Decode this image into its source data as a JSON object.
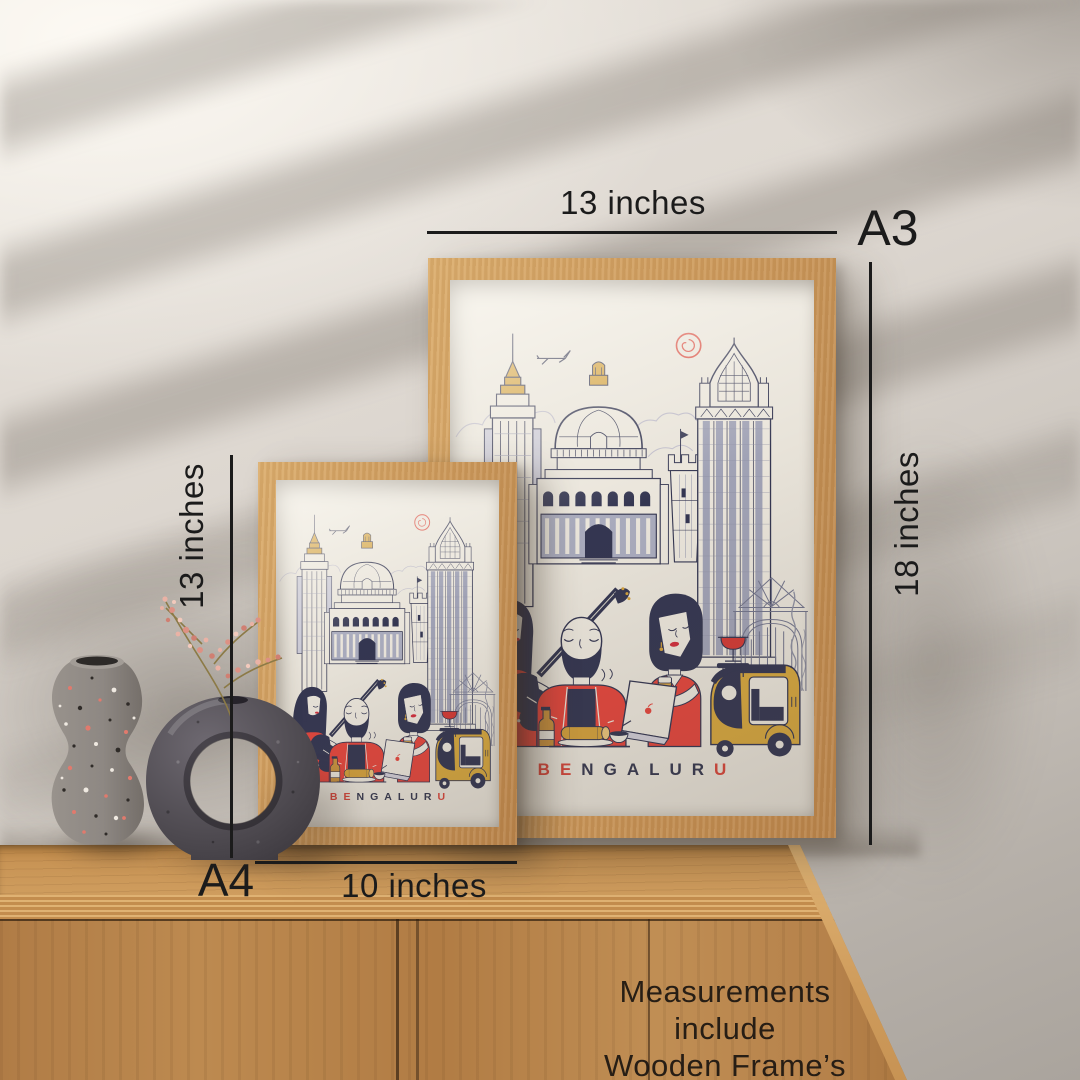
{
  "annotations": {
    "a3_width": "13 inches",
    "a3_size_label": "A3",
    "a3_height": "18 inches",
    "a4_height": "13 inches",
    "a4_width": "10 inches",
    "a4_size_label": "A4",
    "note_line1": "Measurements include",
    "note_line2": "Wooden Frame’s width"
  },
  "poster": {
    "title": "BENGALURU",
    "title_letters": [
      {
        "ch": "B",
        "color": "#d7463b"
      },
      {
        "ch": "E",
        "color": "#d7463b"
      },
      {
        "ch": "N",
        "color": "#36384f"
      },
      {
        "ch": "G",
        "color": "#36384f"
      },
      {
        "ch": "A",
        "color": "#36384f"
      },
      {
        "ch": "L",
        "color": "#36384f"
      },
      {
        "ch": "U",
        "color": "#36384f"
      },
      {
        "ch": "R",
        "color": "#36384f"
      },
      {
        "ch": "U",
        "color": "#d7463b"
      }
    ]
  },
  "colors": {
    "annotation_text": "#1b1b1b",
    "frame_wood": "#cd9a5c",
    "poster_paper": "#e8e3d9",
    "illustration_navy": "#343651",
    "illustration_red": "#e2463d",
    "illustration_gold": "#d2a03c",
    "wall_light": "#e9e4dd",
    "wall_shadow": "#b6b0a9",
    "cabinet_wood": "#b5824a",
    "terrazzo_vase": "#8e8883",
    "donut_vase": "#57535a"
  }
}
